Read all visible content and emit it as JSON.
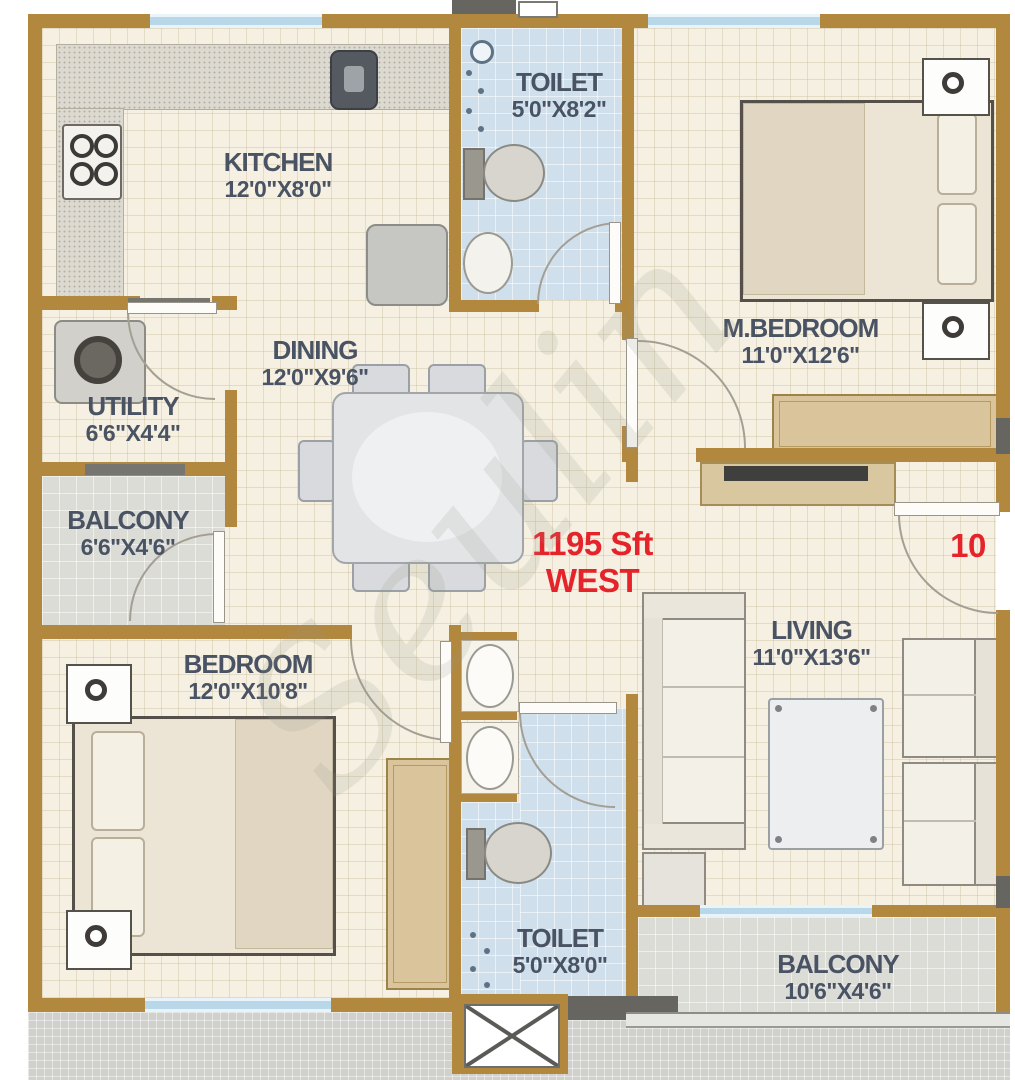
{
  "plan": {
    "watermark": "Seulin",
    "center": {
      "area": "1195 Sft",
      "facing": "WEST"
    },
    "unit_number": "10",
    "rooms": [
      {
        "name": "KITCHEN",
        "dims": "12'0\"X8'0\""
      },
      {
        "name": "TOILET",
        "dims": "5'0\"X8'2\""
      },
      {
        "name": "M.BEDROOM",
        "dims": "11'0\"X12'6\""
      },
      {
        "name": "UTILITY",
        "dims": "6'6\"X4'4\""
      },
      {
        "name": "DINING",
        "dims": "12'0\"X9'6\""
      },
      {
        "name": "BALCONY",
        "dims": "6'6\"X4'6\""
      },
      {
        "name": "LIVING",
        "dims": "11'0\"X13'6\""
      },
      {
        "name": "BEDROOM",
        "dims": "12'0\"X10'8\""
      },
      {
        "name": "TOILET",
        "dims": "5'0\"X8'0\""
      },
      {
        "name": "BALCONY",
        "dims": "10'6\"X4'6\""
      }
    ],
    "colors": {
      "wall": "#b2883f",
      "column": "#66655f",
      "floor": "#f5f0e1",
      "toilet_floor": "#cfdfec",
      "balcony_floor": "#dcdcd7",
      "common_floor": "#d0d0cc",
      "window": "#b8d8ea",
      "accent_red": "#e6232a",
      "label": "#4a5364",
      "wood": "#d9c49c"
    },
    "fixtures": [
      "gas-stove",
      "kitchen-sink",
      "fridge",
      "dining-table",
      "washing-machine",
      "double-bed",
      "wardrobe",
      "nightstand-lamp",
      "tv-unit",
      "sofa",
      "coffee-table",
      "armchair",
      "side-table",
      "wc",
      "wash-basin",
      "shower",
      "lift"
    ]
  }
}
